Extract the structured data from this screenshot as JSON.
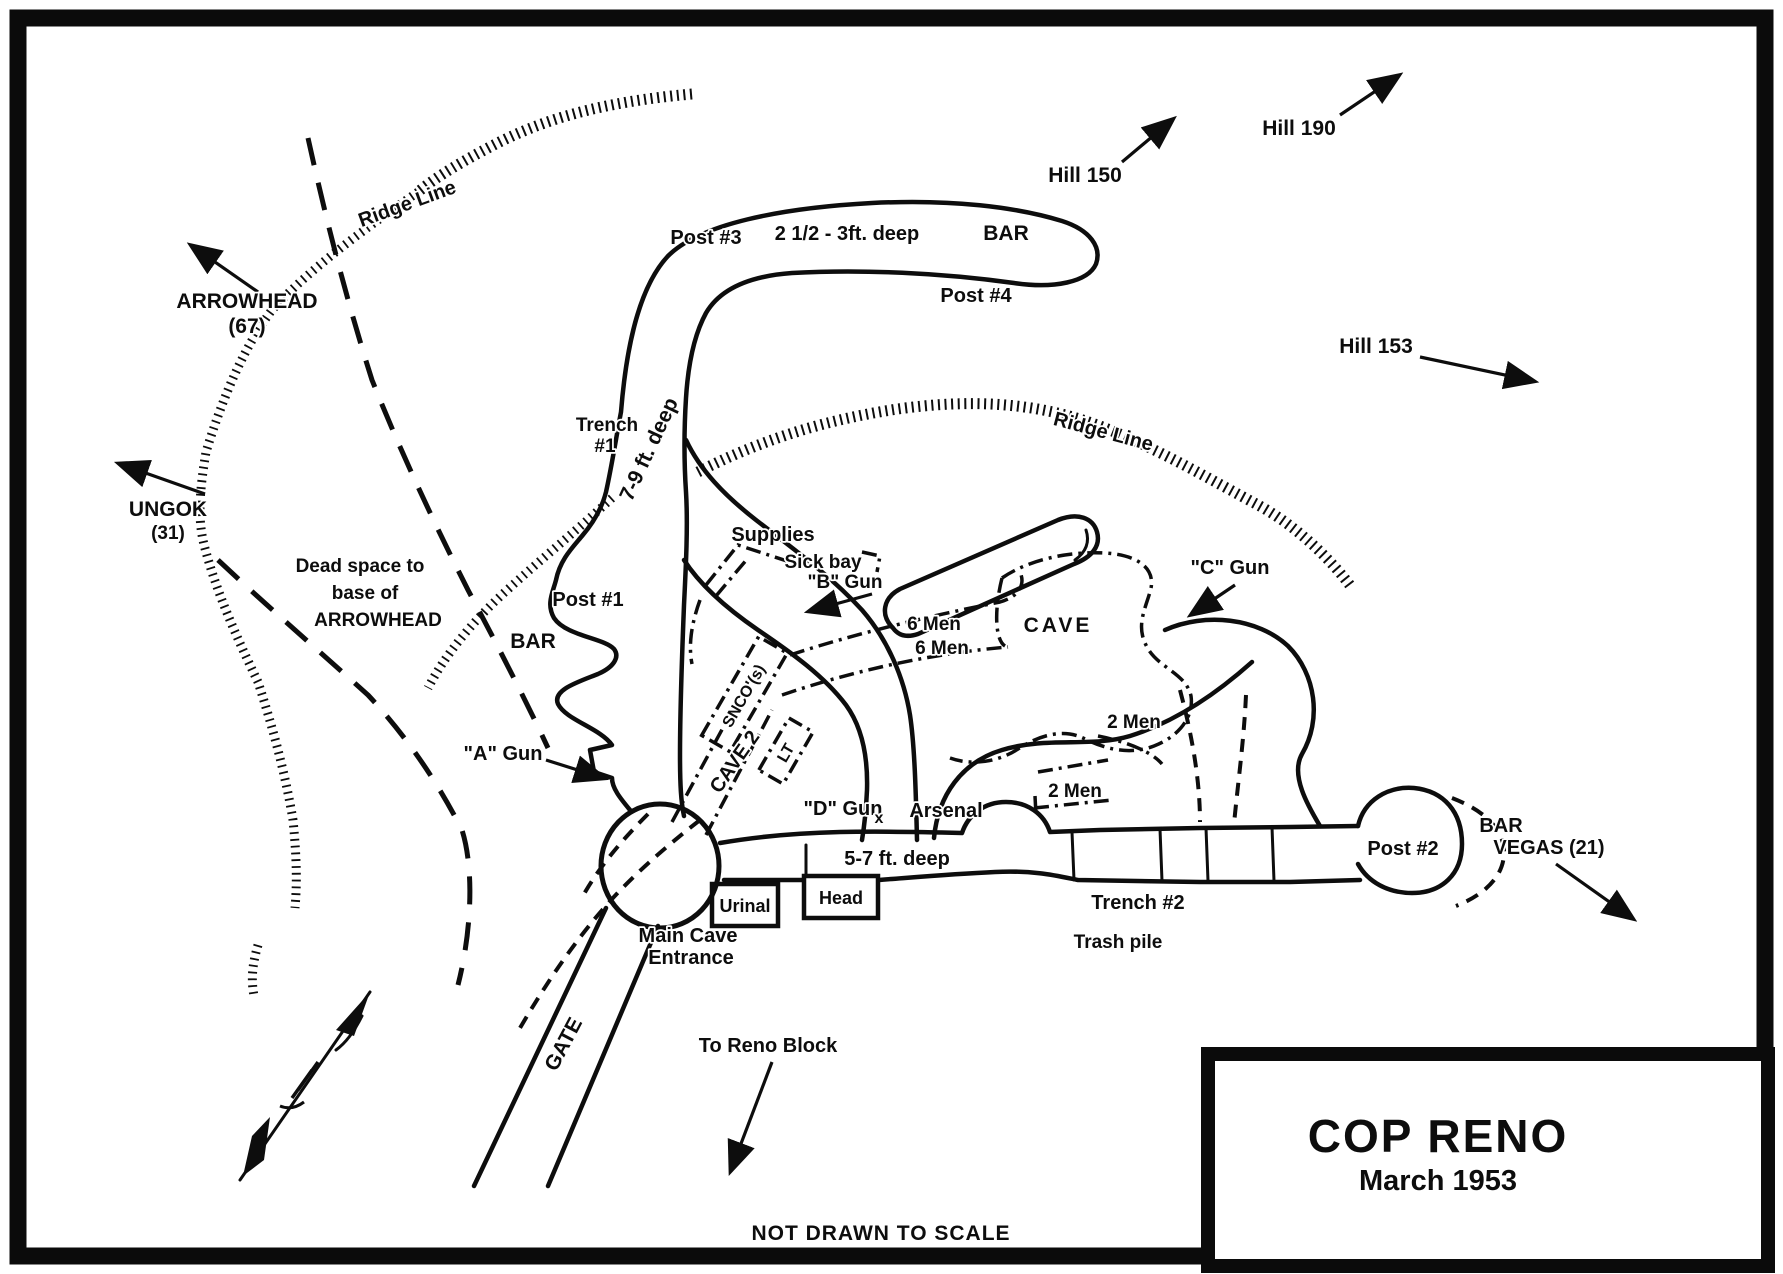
{
  "map": {
    "title": "COP RENO",
    "date": "March 1953",
    "scale_note": "NOT DRAWN TO SCALE",
    "terrain": {
      "ridge_left": "Ridge Line",
      "ridge_right": "Ridge Line",
      "arrowhead": "ARROWHEAD",
      "arrowhead_elev": "(67)",
      "ungok": "UNGOK",
      "ungok_elev": "(31)",
      "hill_150": "Hill 150",
      "hill_190": "Hill 190",
      "hill_153": "Hill 153",
      "dead_space_1": "Dead space to",
      "dead_space_2": "base of",
      "dead_space_3": "ARROWHEAD",
      "vegas_1": "BAR",
      "vegas_2": "VEGAS (21)"
    },
    "positions": {
      "post_1": "Post #1",
      "post_2": "Post #2",
      "post_3": "Post #3",
      "post_4": "Post #4",
      "bar_north": "BAR",
      "bar_west": "BAR",
      "gun_a": "\"A\" Gun",
      "gun_b": "\"B\" Gun",
      "gun_c": "\"C\" Gun",
      "gun_d": "\"D\" Gun",
      "gun_d_mark": "x",
      "men_6a": "6 Men",
      "men_6b": "6 Men",
      "men_2a": "2 Men",
      "men_2b": "2 Men"
    },
    "trenches": {
      "trench_1_line1": "Trench",
      "trench_1_line2": "#1",
      "trench_1_depth": "7-9 ft. deep",
      "loop_depth": "2 1/2 - 3ft. deep",
      "trench_2": "Trench #2",
      "trench_2_depth": "5-7 ft. deep"
    },
    "facilities": {
      "supplies": "Supplies",
      "sick_bay": "Sick bay",
      "arsenal": "Arsenal",
      "urinal": "Urinal",
      "head": "Head",
      "trash": "Trash pile",
      "cave": "CAVE",
      "cave_2": "CAVE 2",
      "snco": "SNCO'(s)",
      "lt": "LT",
      "main_cave_1": "Main Cave",
      "main_cave_2": "Entrance",
      "gate": "GATE",
      "to_reno": "To Reno Block"
    }
  }
}
